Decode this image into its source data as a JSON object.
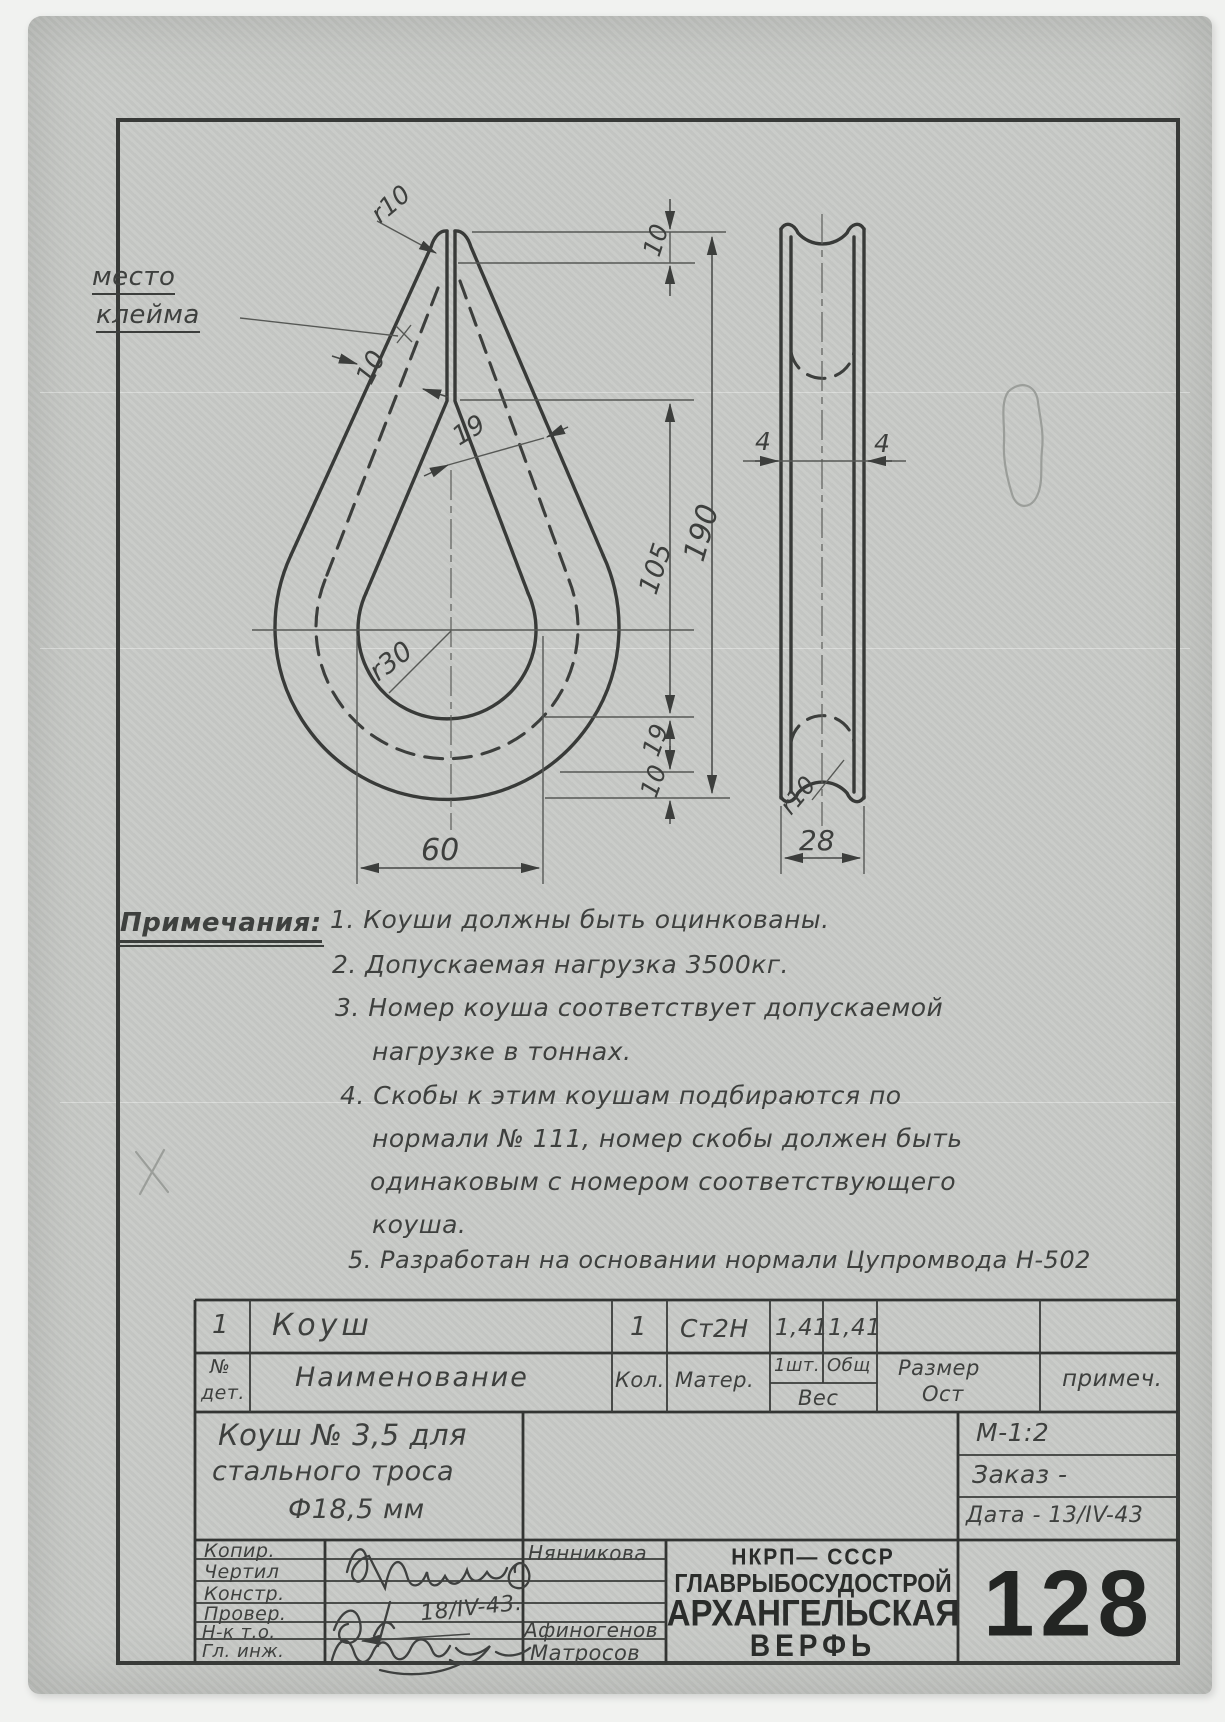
{
  "drawing": {
    "stamp_callout": {
      "line1": "место",
      "line2": "клейма"
    },
    "dims": {
      "apex_radius": "r10",
      "strip_thickness": "10",
      "groove_width": "19",
      "inner_radius": "r30",
      "width_bottom": "60",
      "top_10": "10",
      "h_105": "105",
      "h_190": "190",
      "low_19": "19",
      "low_10": "10",
      "side_4_left": "4",
      "side_4_right": "4",
      "side_r10": "r10",
      "side_28": "28"
    }
  },
  "notes": {
    "heading": "Примечания:",
    "lines": [
      "1. Коуши должны быть оцинкованы.",
      "2. Допускаемая нагрузка 3500кг.",
      "3. Номер коуша соответствует допускаемой",
      "нагрузке в тоннах.",
      "4. Скобы к этим коушам подбираются по",
      "нормали № 111, номер скобы должен быть",
      "одинаковым с номером соответствующего",
      "коуша.",
      "5. Разработан на основании нормали Цупромвода Н-502"
    ]
  },
  "parts_table": {
    "row": {
      "num": "1",
      "name": "Коуш",
      "qty": "1",
      "material": "Ст2Н",
      "weight_each": "1,41",
      "weight_total": "1,41"
    },
    "header": {
      "det_no_1": "№",
      "det_no_2": "дет.",
      "name": "Наименование",
      "qty": "Кол.",
      "material": "Матер.",
      "weight_each": "1шт.",
      "weight_total": "Общ",
      "weight": "Вес",
      "size_1": "Размер",
      "size_2": "Ост",
      "note": "примеч."
    }
  },
  "title_block": {
    "title_line1": "Коуш № 3,5 для",
    "title_line2": "стального троса",
    "title_line3": "Ф18,5 мм",
    "scale": "М-1:2",
    "order": "Заказ -",
    "date": "Дата - 13/IV-43"
  },
  "sign_block": {
    "labels": [
      "Копир.",
      "Чертил",
      "Констр.",
      "Провер.",
      "Н-к т.о.",
      "Гл. инж."
    ],
    "names": {
      "copier": "Нянникова",
      "dept_head": "Афиногенов",
      "chief_engineer": "Матросов"
    },
    "date_note": "18/IV-43."
  },
  "stamp": {
    "line1": "НКРП— СССР",
    "line2": "ГЛАВРЫБОСУДОСТРОЙ",
    "line3": "АРХАНГЕЛЬСКАЯ",
    "line4": "ВЕРФЬ"
  },
  "sheet_number": "128"
}
